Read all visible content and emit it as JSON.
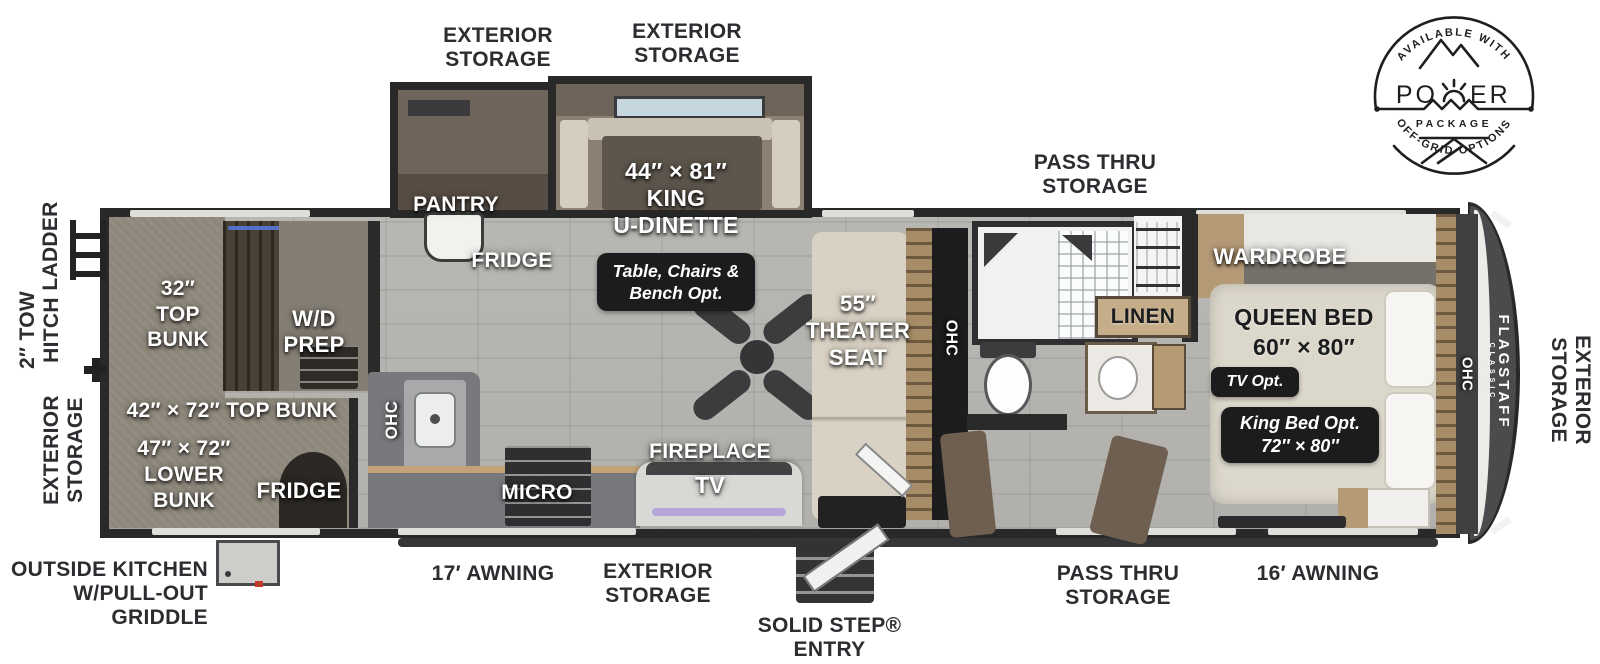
{
  "power_badge": {
    "arc_top": "AVAILABLE WITH",
    "word_left": "PO",
    "word_right": "ER",
    "package": "PACKAGE",
    "arc_bottom": "OFF-GRID OPTIONS"
  },
  "brand": {
    "name": "FLAGSTAFF",
    "series": "CLASSIC"
  },
  "exterior": {
    "storage_top_1": [
      "EXTERIOR",
      "STORAGE"
    ],
    "storage_top_2": [
      "EXTERIOR",
      "STORAGE"
    ],
    "pass_thru_top": [
      "PASS THRU",
      "STORAGE"
    ],
    "ladder": "LADDER",
    "tow_hitch": [
      "2″ TOW",
      "HITCH"
    ],
    "storage_left": [
      "EXTERIOR",
      "STORAGE"
    ],
    "storage_right": [
      "EXTERIOR",
      "STORAGE"
    ],
    "outside_kitchen": [
      "OUTSIDE KITCHEN",
      "W/PULL-OUT",
      "GRIDDLE"
    ],
    "awning_17": "17′ AWNING",
    "storage_bottom": [
      "EXTERIOR",
      "STORAGE"
    ],
    "solid_step": [
      "SOLID STEP®",
      "ENTRY"
    ],
    "pass_thru_bottom": [
      "PASS THRU",
      "STORAGE"
    ],
    "awning_16": "16′ AWNING"
  },
  "interior": {
    "pantry": "PANTRY",
    "fridge_kitchen": "FRIDGE",
    "king_dinette": [
      "44″ × 81″",
      "KING",
      "U-DINETTE"
    ],
    "dinette_option": [
      "Table, Chairs &",
      "Bench Opt."
    ],
    "top_bunk_32": [
      "32″",
      "TOP",
      "BUNK"
    ],
    "wd_prep": [
      "W/D",
      "PREP"
    ],
    "top_bunk_42": "42″ × 72″ TOP BUNK",
    "lower_bunk_47": [
      "47″ × 72″",
      "LOWER",
      "BUNK"
    ],
    "fridge_bunk": "FRIDGE",
    "ohc_kitchen": "OHC",
    "micro": "MICRO",
    "fireplace": "FIREPLACE",
    "tv": "TV",
    "theater_seat": [
      "55″",
      "THEATER",
      "SEAT"
    ],
    "ohc_living": "OHC",
    "linen": "LINEN",
    "wardrobe": "WARDROBE",
    "queen_bed": [
      "QUEEN BED",
      "60″ × 80″"
    ],
    "tv_option": "TV Opt.",
    "king_option": [
      "King Bed Opt.",
      "72″ × 80″"
    ],
    "ohc_bedroom": "OHC"
  },
  "colors": {
    "label_ink": "#2b2d30",
    "wall": "#2a2a2b",
    "floor": "#b5b4b0",
    "carpet": "#8e877b",
    "badge_bg": "#1c1c1e",
    "tv_glow": "#b5a7dd",
    "cap_gray": "#4a4b4d"
  }
}
